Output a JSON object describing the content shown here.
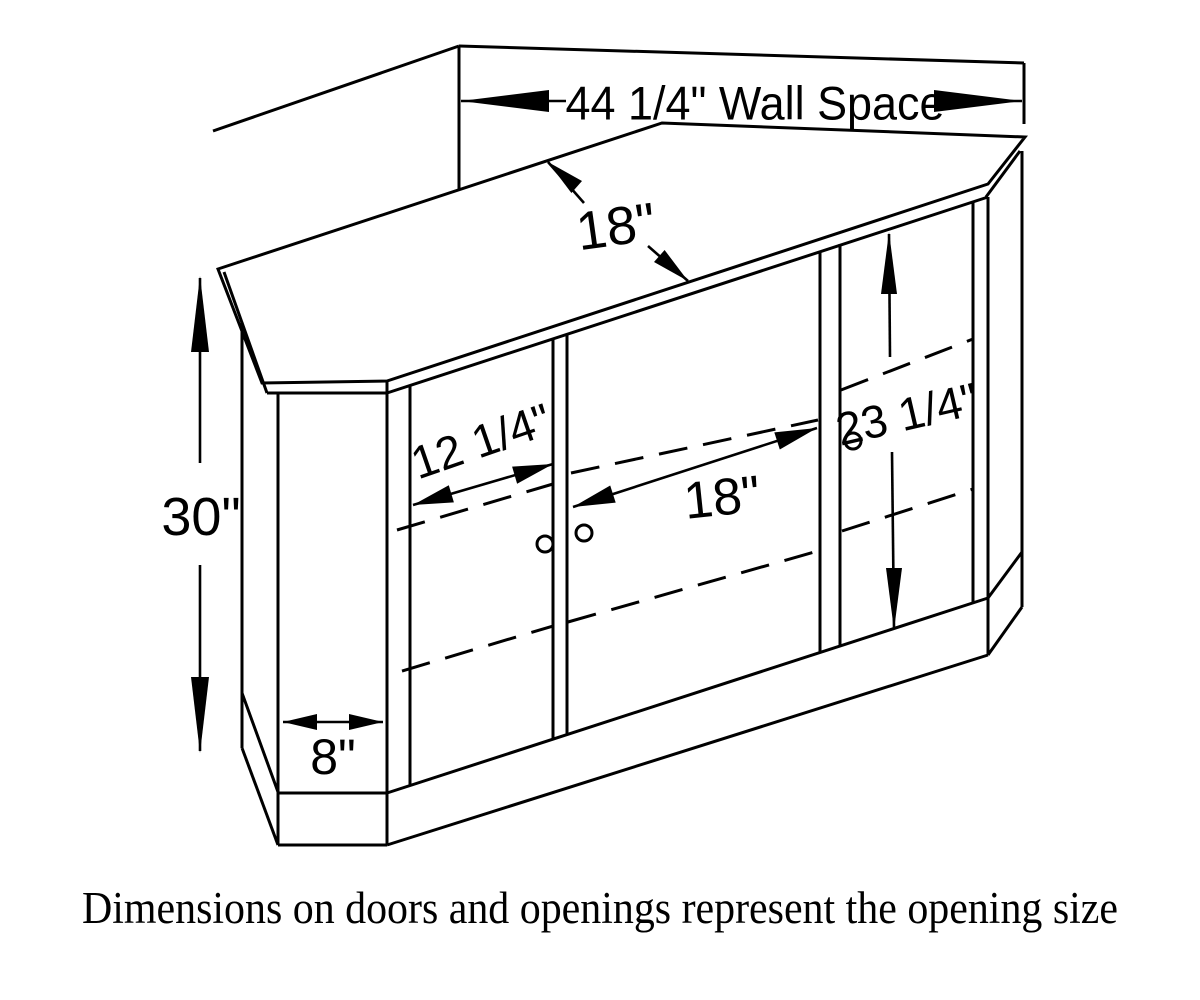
{
  "diagram": {
    "type": "furniture-dimension-drawing",
    "subject": "corner TV cabinet with three door sections",
    "labels": {
      "wall_space": "44 1/4\" Wall Space",
      "top_depth": "18\"",
      "cabinet_height": "30\"",
      "left_door_opening": "12 1/4\"",
      "center_door_opening": "18\"",
      "right_opening_height": "23 1/4\"",
      "side_panel_width": "8\""
    },
    "caption": "Dimensions on doors and openings represent the opening size",
    "colors": {
      "line": "#000000",
      "background": "#ffffff"
    }
  }
}
